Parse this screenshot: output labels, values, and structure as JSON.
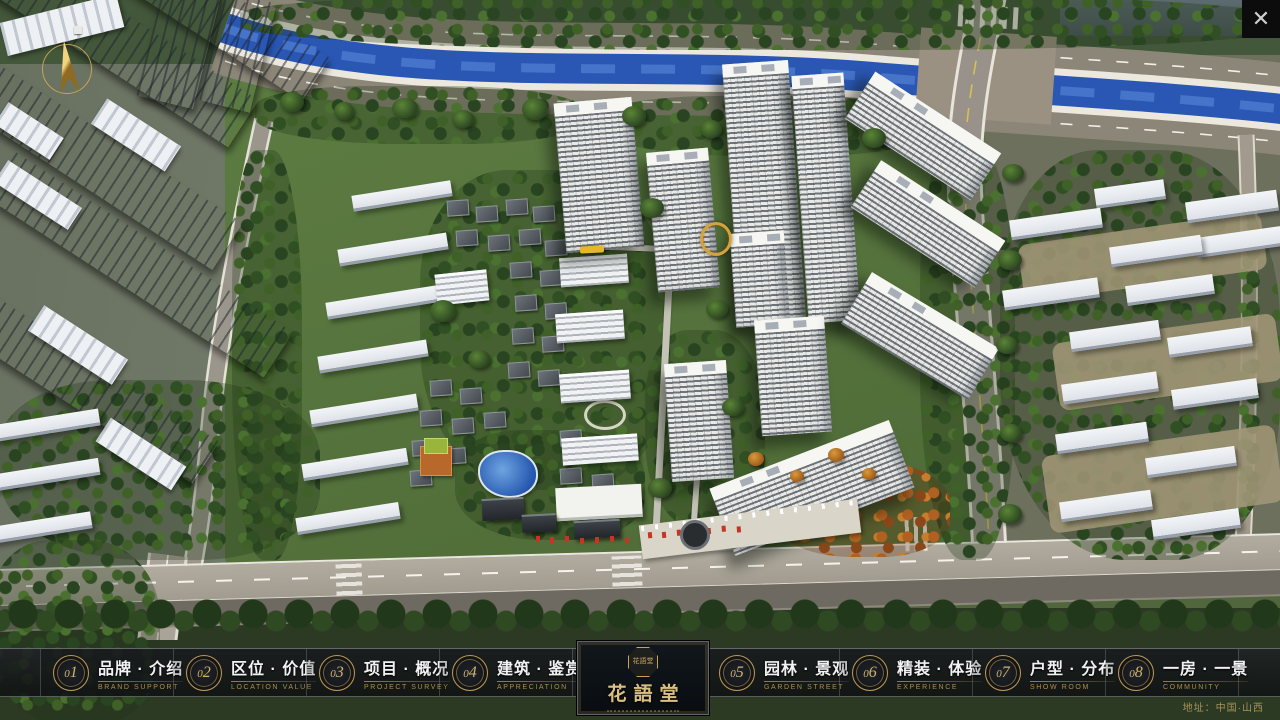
{
  "window": {
    "close_icon": "✕"
  },
  "nav": {
    "items": [
      {
        "number": "01",
        "label_cn": "品牌 · 介绍",
        "label_en": "BRAND SUPPORT"
      },
      {
        "number": "02",
        "label_cn": "区位 · 价值",
        "label_en": "LOCATION VALUE"
      },
      {
        "number": "03",
        "label_cn": "项目 · 概况",
        "label_en": "PROJECT SURVEY"
      },
      {
        "number": "04",
        "label_cn": "建筑 · 鉴赏",
        "label_en": "APPRECIATION"
      },
      {
        "number": "05",
        "label_cn": "园林 · 景观",
        "label_en": "GARDEN STREET"
      },
      {
        "number": "06",
        "label_cn": "精装 · 体验",
        "label_en": "EXPERIENCE"
      },
      {
        "number": "07",
        "label_cn": "户型 · 分布",
        "label_en": "SHOW ROOM"
      },
      {
        "number": "08",
        "label_cn": "一房 · 一景",
        "label_en": "COMMUNITY"
      }
    ]
  },
  "logo": {
    "name": "花語堂",
    "seal_text": "花語堂"
  },
  "footer": {
    "address": "地址：中国·山西"
  },
  "palette": {
    "accent_gold": "#c9a861",
    "bar_bg": "#14171a",
    "river_blue": "#2a57b4",
    "tree_green": "#3c5a2a",
    "road_gray": "#9a948a",
    "lawn_green": "#5d7c42"
  }
}
